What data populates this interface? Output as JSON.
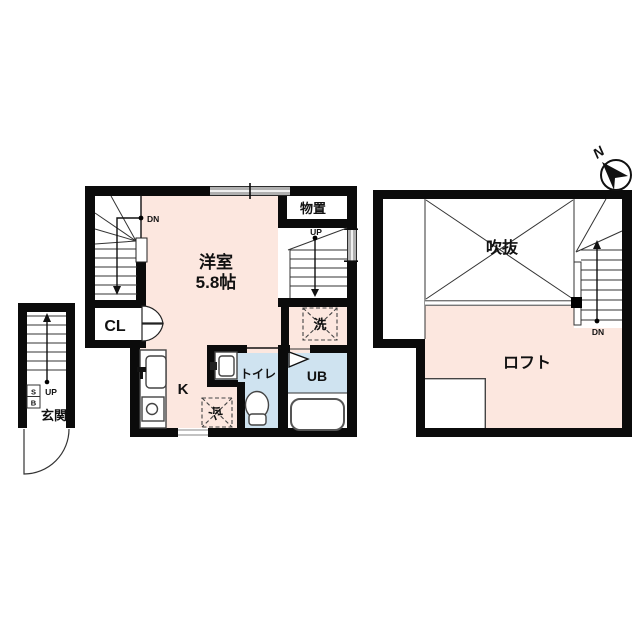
{
  "document": {
    "type": "floor-plan",
    "title": "1R apartment floor plan with loft"
  },
  "colors": {
    "room_fill": "#fce7df",
    "wet_area_fill": "#cfe3f0",
    "wall": "#0b0b0b",
    "window_gray": "#b0b0b0"
  },
  "floor1": {
    "room_label": "洋室",
    "room_size": "5.8帖",
    "storage_label": "物置",
    "closet_label": "CL",
    "kitchen_label": "K",
    "toilet_label": "トイレ",
    "bath_label": "UB",
    "washer_label": "洗",
    "fridge_label": "冷",
    "entrance_label": "玄関",
    "shoebox_top": "S",
    "shoebox_bottom": "B",
    "stairs_down_label": "DN",
    "stairs_up_label": "UP",
    "entrance_up_label": "UP"
  },
  "floor2": {
    "void_label": "吹抜",
    "loft_label": "ロフト",
    "stairs_down_label": "DN"
  },
  "compass": {
    "north_label": "N"
  }
}
